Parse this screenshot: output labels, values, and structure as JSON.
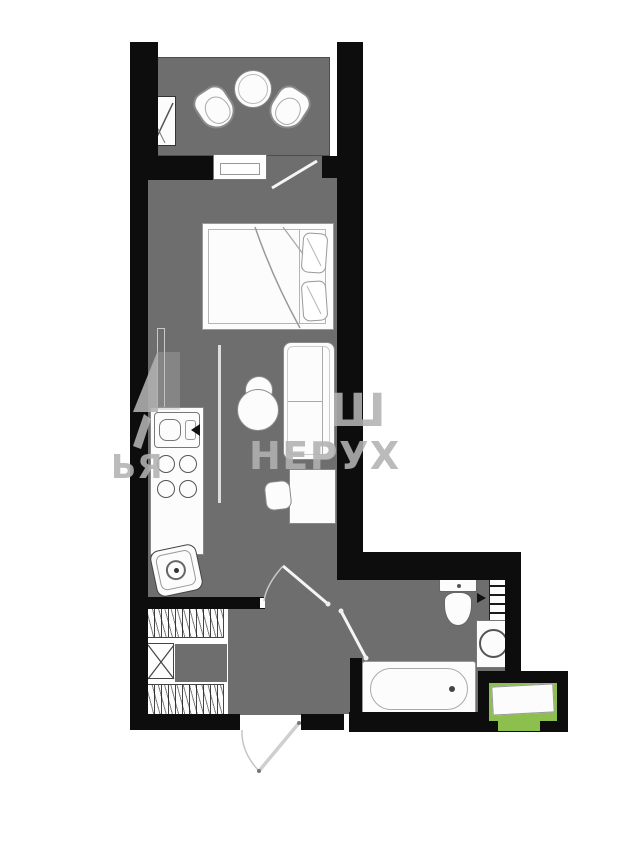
{
  "document": {
    "type": "apartment-floor-plan",
    "orientation": "portrait"
  },
  "palette": {
    "background": "#ffffff",
    "wall": "#0d0d0d",
    "floor": "#6e6e6e",
    "fixture_fill": "#fcfcfc",
    "fixture_line": "#8a8a8a",
    "accent_green": "#8dbf4e",
    "watermark_gray": "#b2b2b2"
  },
  "watermark": {
    "row1_fragment": "Ш",
    "row2_fragment": "НЕРУХ",
    "left_fragment": "ЬЯ"
  },
  "rooms": [
    {
      "name": "balcony",
      "fixtures": [
        "round-bistro-table",
        "chair-left",
        "chair-right",
        "ac-unit"
      ]
    },
    {
      "name": "living-room",
      "fixtures": [
        "double-bed",
        "sofa",
        "desk",
        "desk-chair",
        "armchair",
        "kitchen-counter",
        "kitchen-sink",
        "stove",
        "washing-machine"
      ]
    },
    {
      "name": "hallway",
      "fixtures": [
        "wardrobe-rail-top",
        "duct-shaft",
        "wardrobe-rail-bottom",
        "entry-door"
      ]
    },
    {
      "name": "bathroom",
      "fixtures": [
        "toilet",
        "towel-radiator",
        "washbasin",
        "bathtub"
      ]
    },
    {
      "name": "loggia",
      "fixtures": [
        "green-highlighted-area"
      ]
    }
  ]
}
